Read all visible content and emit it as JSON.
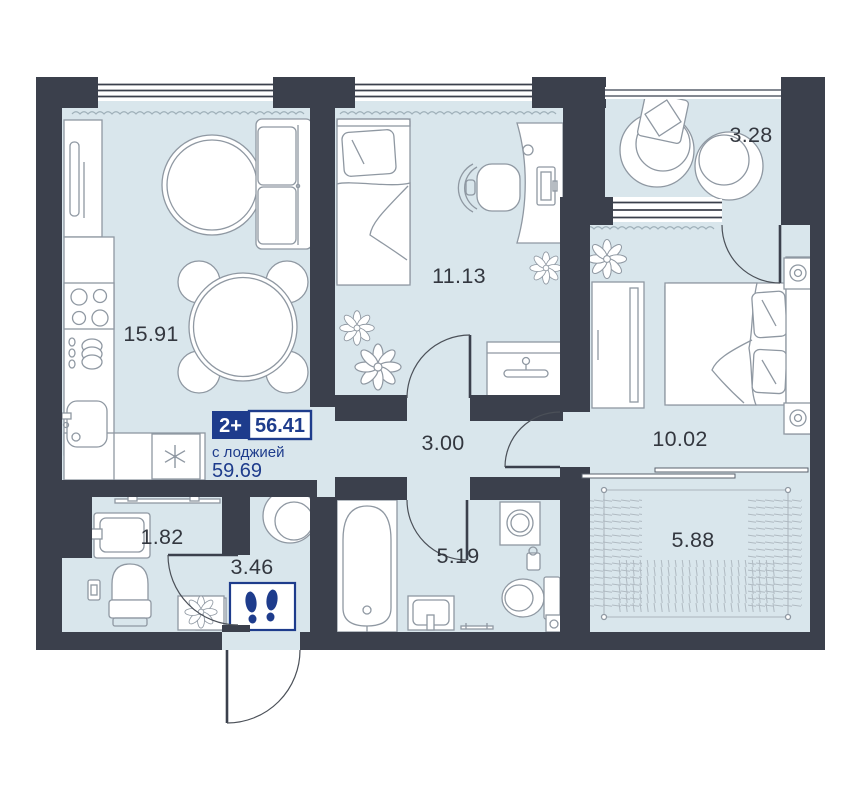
{
  "unit_card": {
    "rooms_badge": "2+",
    "total_area": "56.41",
    "with_loggia_label": "с лоджией",
    "with_loggia_area": "59.69"
  },
  "room_areas": {
    "kitchen_living": "15.91",
    "bedroom_small": "11.13",
    "balcony": "3.28",
    "bedroom_master": "10.02",
    "corridor": "3.00",
    "bathroom": "5.19",
    "wc": "1.82",
    "hallway": "3.46",
    "loggia": "5.88"
  },
  "icons": {
    "entrance_mat": "footprints-icon",
    "fridge": "snowflake-icon",
    "wardrobe": "hanger-icon",
    "plants": "flower-icon"
  },
  "colors": {
    "wall": "#3b404c",
    "floor": "#d9e6ec",
    "accent_navy": "#1e3c8c",
    "furniture_stroke": "#8f98a2",
    "label_text": "#33373f",
    "background": "#ffffff"
  }
}
